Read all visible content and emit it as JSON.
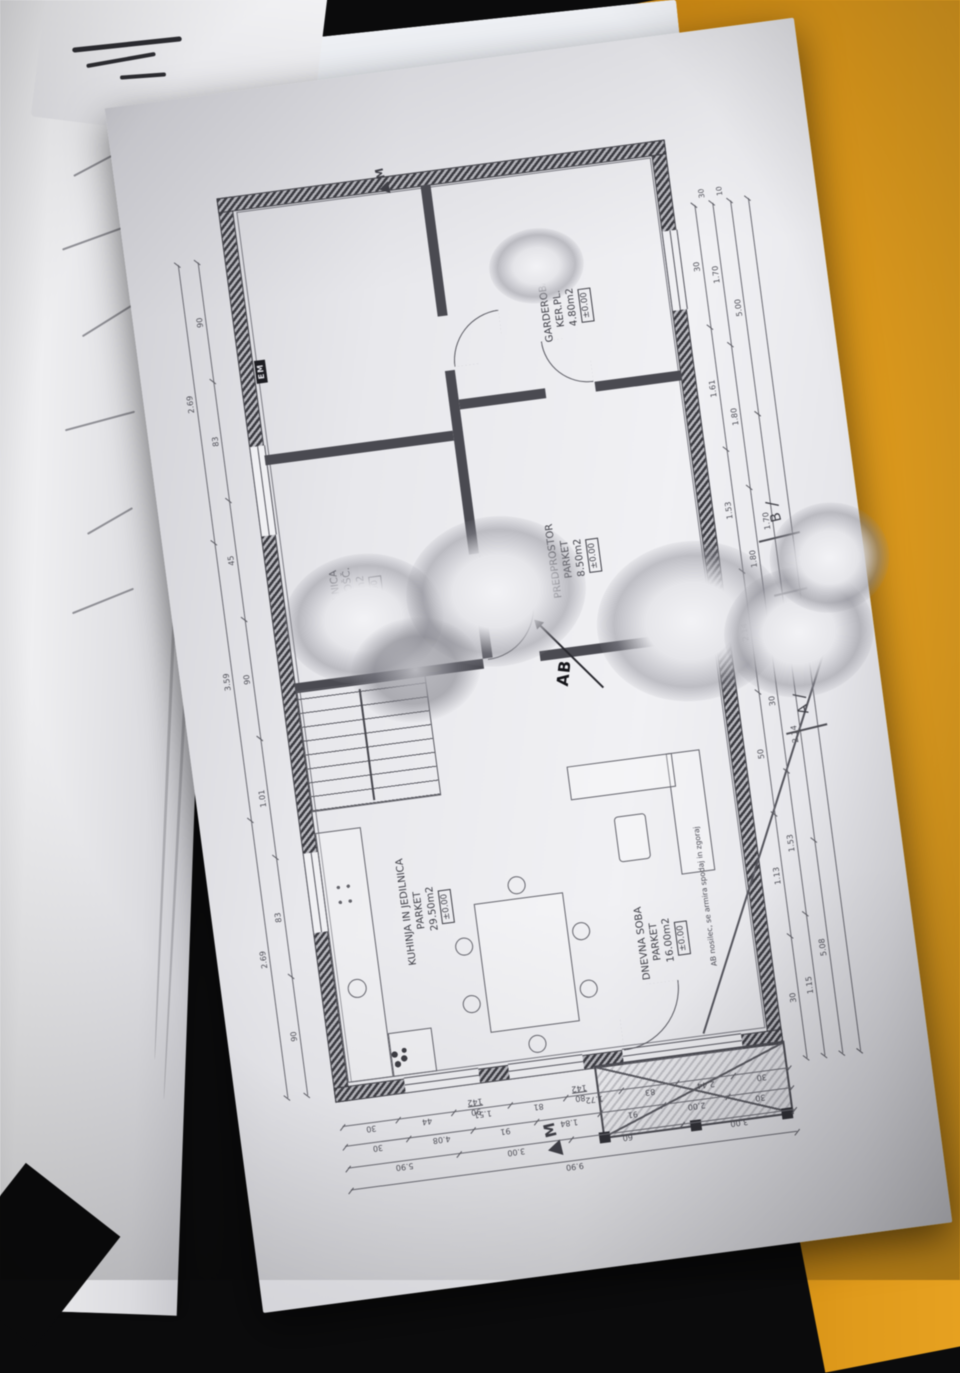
{
  "scene": {
    "background_color": "#0b0b0c",
    "orange_folder_color": "#e69b10",
    "red_folder_color": "#a32017",
    "notebook": {
      "ink_color": "#3c4c9d",
      "handwriting": {
        "prefix1": "0",
        "line1_struck": "KONČNI",
        "line1": "KONČNIK",
        "prefix2": "0",
        "line2": "KOPJE"
      }
    }
  },
  "plan": {
    "rooms": [
      {
        "name": "KUHINJA IN JEDILNICA",
        "floor": "PARKET",
        "area": "29.50m2",
        "level": "±0.00"
      },
      {
        "name": "DNEVNA SOBA",
        "floor": "PARKET",
        "area": "16.00m2",
        "level": "±0.00"
      },
      {
        "name": "PREDPROSTOR",
        "floor": "PARKET",
        "area": "8.50m2",
        "level": "±0.00"
      },
      {
        "name": "KOPALNICA",
        "floor": "KER.PLOŠČ.",
        "area": "3.90m2",
        "level": "±0.00"
      },
      {
        "name": "GARDEROBA",
        "floor": "KER.PL.",
        "area": "4.80m2",
        "level": "±0.00"
      }
    ],
    "notes": {
      "beam": "AB nosilec, se armira spodaj in zgoraj"
    },
    "markers": {
      "section_ab_stamp": "AB",
      "section_a": "A",
      "section_b": "B",
      "slash": "∕",
      "electric_meter": "EM",
      "north": "M"
    },
    "window_tags": [
      {
        "w": "90",
        "h": "142"
      },
      {
        "w": "80",
        "h": "142"
      }
    ],
    "dimensions": {
      "left_rows": [
        [
          "30",
          "2.44",
          "83",
          "1.72",
          "81",
          "1.51",
          "44",
          "30"
        ],
        [
          "30",
          "2.00",
          "91",
          "1.84",
          "91",
          "4.08",
          "30"
        ],
        [
          "3.00",
          "60",
          "3.00",
          "5.90"
        ],
        [
          "9.90"
        ]
      ],
      "bottom_rows": [
        [
          "30",
          "1.13",
          "50",
          "2.14",
          "1.53",
          "1.61",
          "30"
        ],
        [
          "1.15",
          "1.53",
          "30",
          "1.80",
          "1.80",
          "1.70"
        ],
        [
          "5.08",
          "2.14",
          "1.70",
          "5.00"
        ],
        [
          "13.70"
        ]
      ],
      "right_rows": [
        [
          "90",
          "83",
          "1.01",
          "90",
          "45",
          "83",
          "90"
        ],
        [
          "2.69",
          "3.59",
          "2.69"
        ]
      ],
      "corner_ticks": [
        "30",
        "10"
      ]
    }
  }
}
